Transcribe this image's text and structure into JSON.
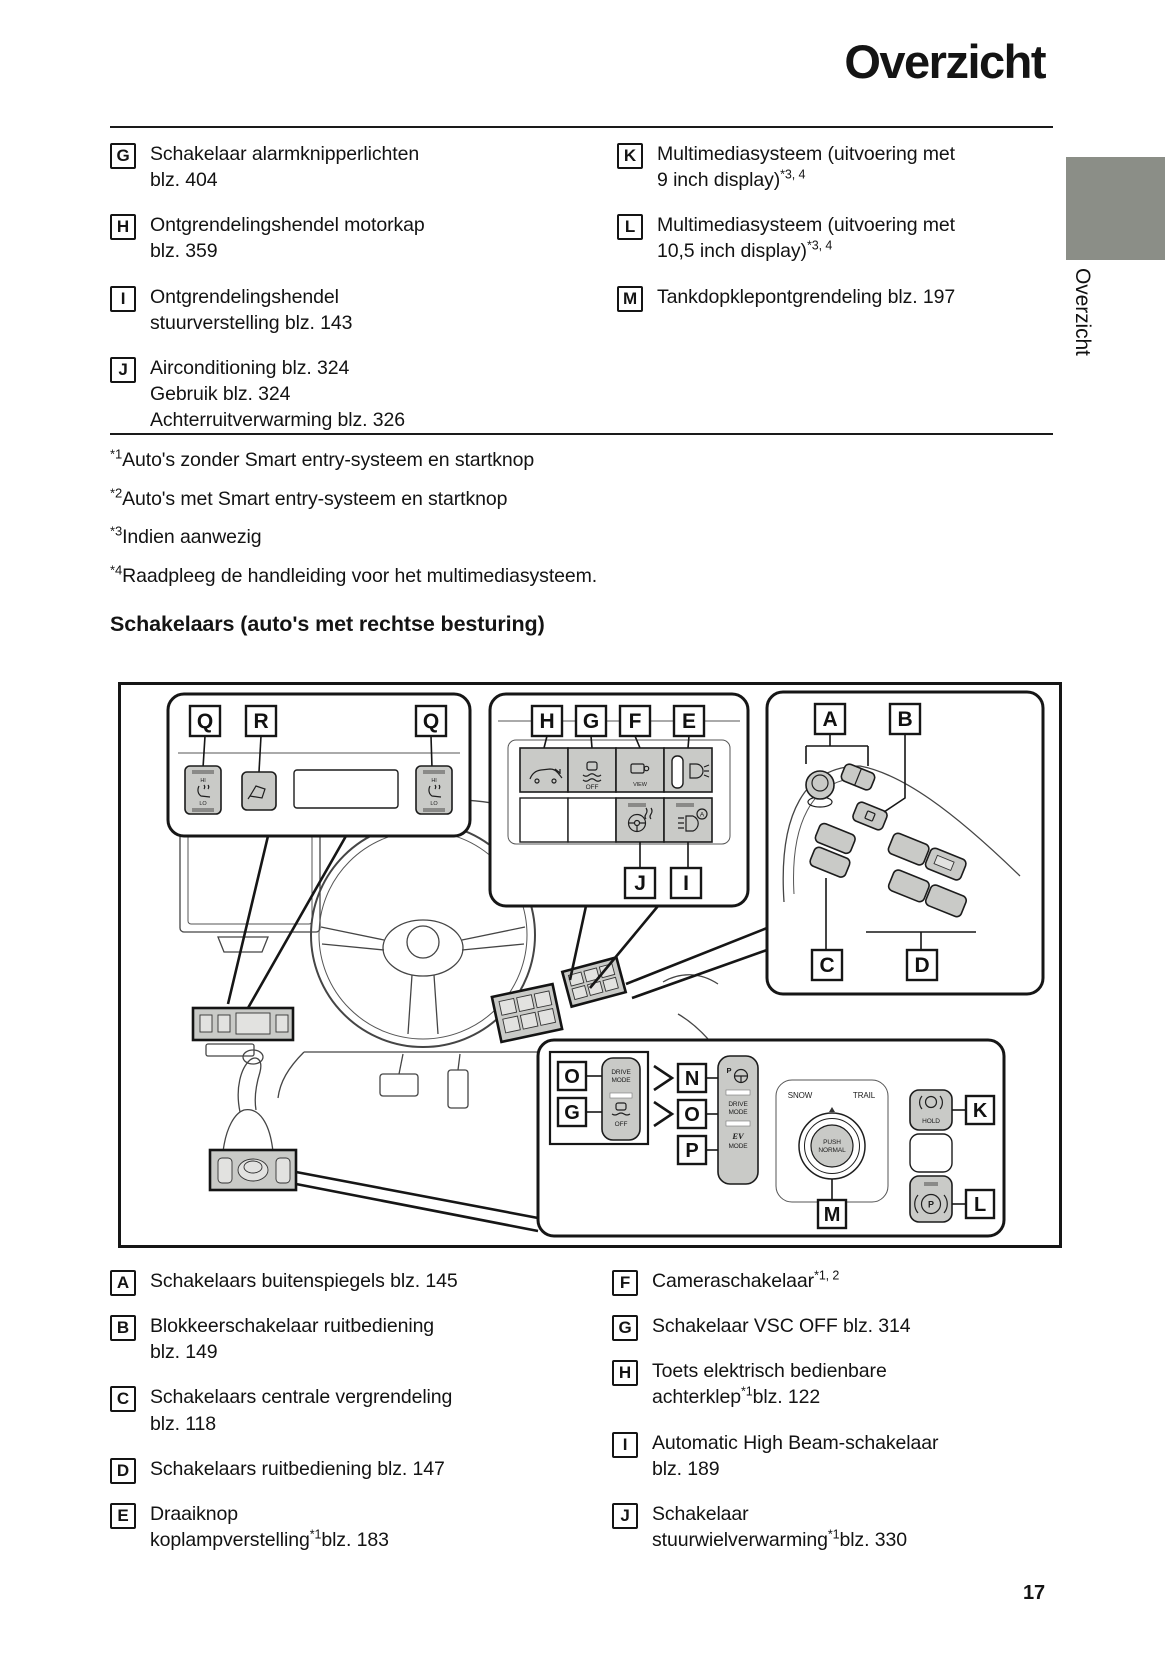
{
  "page": {
    "title": "Overzicht",
    "side_tab": "Overzicht",
    "section_heading": "Schakelaars (auto's met rechtse besturing)",
    "page_number": "17"
  },
  "top_list": {
    "left": [
      {
        "letter": "G",
        "line1": "Schakelaar alarmknipperlichten",
        "text": "blz. 404"
      },
      {
        "letter": "H",
        "line1": "Ontgrendelingshendel motorkap",
        "text": "blz. 359"
      },
      {
        "letter": "I",
        "line1": "Ontgrendelingshendel",
        "text": "stuurverstelling blz. 143"
      },
      {
        "letter": "J",
        "line1": "Airconditioning blz. 324",
        "line2": "Gebruik blz. 324",
        "text": "Achterruitverwarming blz. 326"
      }
    ],
    "right": [
      {
        "letter": "K",
        "line1": "Multimediasysteem (uitvoering met",
        "text": "9 inch display)",
        "sup": "*3, 4"
      },
      {
        "letter": "L",
        "line1": "Multimediasysteem (uitvoering met",
        "text": "10,5 inch display)",
        "sup": "*3, 4"
      },
      {
        "letter": "M",
        "text": "Tankdopklepontgrendeling blz. 197"
      }
    ]
  },
  "footnotes": [
    {
      "marker": "*1",
      "text": "Auto's zonder Smart entry-systeem en startknop"
    },
    {
      "marker": "*2",
      "text": "Auto's met Smart entry-systeem en startknop"
    },
    {
      "marker": "*3",
      "text": "Indien aanwezig"
    },
    {
      "marker": "*4",
      "text": "Raadpleeg de handleiding voor het multimediasysteem."
    }
  ],
  "bottom_list": {
    "left": [
      {
        "letter": "A",
        "text": "Schakelaars buitenspiegels blz. 145"
      },
      {
        "letter": "B",
        "line1": "Blokkeerschakelaar ruitbediening",
        "text": "blz. 149"
      },
      {
        "letter": "C",
        "line1": "Schakelaars centrale vergrendeling",
        "text": "blz. 118"
      },
      {
        "letter": "D",
        "text": "Schakelaars ruitbediening blz. 147"
      },
      {
        "letter": "E",
        "line1": "Draaiknop",
        "text": "koplampverstelling",
        "sup": "*1",
        "text2": "blz. 183"
      }
    ],
    "right": [
      {
        "letter": "F",
        "text": "Cameraschakelaar",
        "sup": "*1, 2"
      },
      {
        "letter": "G",
        "text": "Schakelaar VSC OFF blz. 314"
      },
      {
        "letter": "H",
        "line1": "Toets elektrisch bedienbare",
        "text": "achterklep",
        "sup": "*1",
        "text2": "blz. 122"
      },
      {
        "letter": "I",
        "line1": "Automatic High Beam-schakelaar",
        "text": "blz. 189"
      },
      {
        "letter": "J",
        "line1": "Schakelaar",
        "text": "stuurwielverwarming",
        "sup": "*1",
        "text2": "blz. 330"
      }
    ]
  },
  "diagram": {
    "letters": {
      "q": "Q",
      "r": "R",
      "h": "H",
      "g": "G",
      "f": "F",
      "e": "E",
      "j": "J",
      "i": "I",
      "a": "A",
      "b": "B",
      "c": "C",
      "d": "D",
      "n": "N",
      "o": "O",
      "p": "P",
      "m": "M",
      "k": "K",
      "l": "L"
    },
    "texts": {
      "hi": "HI",
      "lo": "LO",
      "off": "OFF",
      "view": "VIEW",
      "drive": "DRIVE",
      "mode": "MODE",
      "ev": "EV",
      "snow": "SNOW",
      "trail": "TRAIL",
      "push": "PUSH",
      "normal": "NORMAL",
      "hold": "HOLD"
    }
  }
}
